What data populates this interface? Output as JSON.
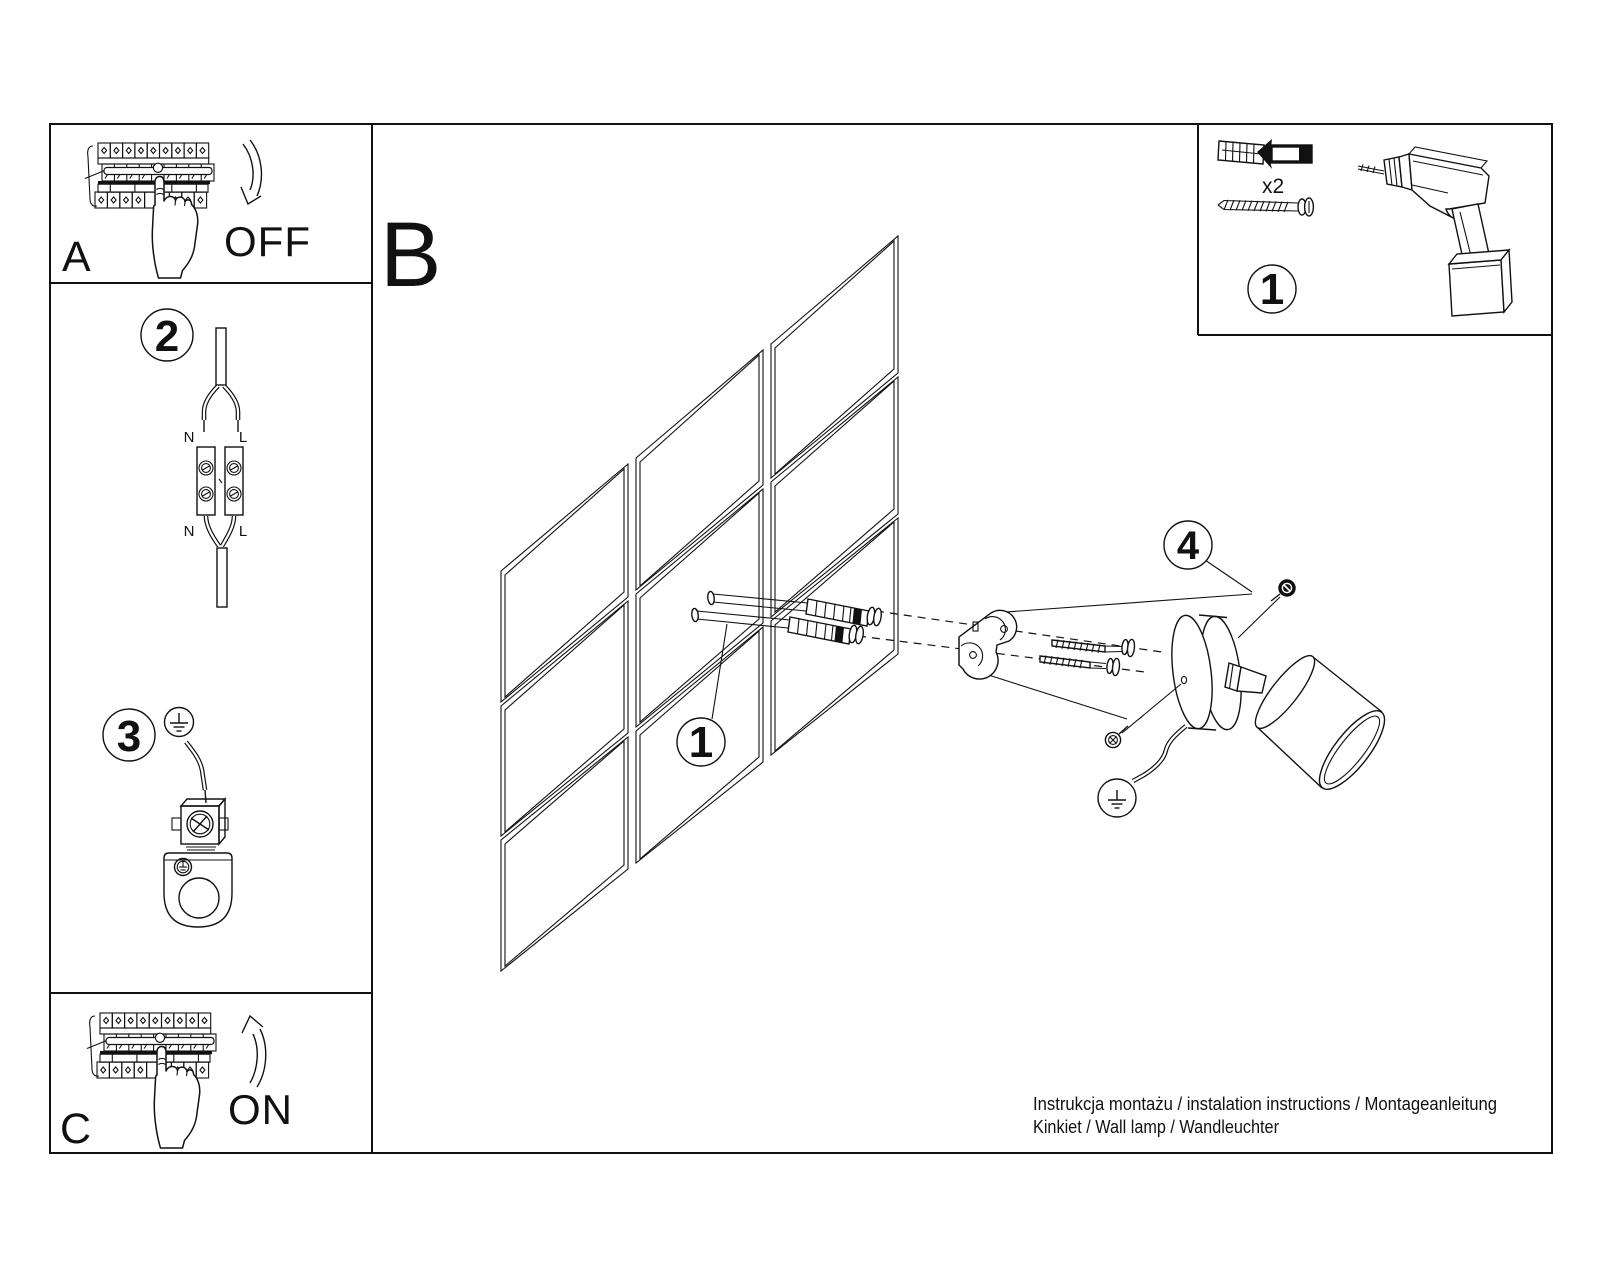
{
  "colors": {
    "ink": "#111111",
    "paper": "#ffffff"
  },
  "sections": {
    "a": "A",
    "b": "B",
    "c": "C"
  },
  "breaker": {
    "off": "OFF",
    "on": "ON"
  },
  "steps": {
    "wall": "1",
    "parts": "1",
    "wiring": "2",
    "ground": "3",
    "lamp": "4"
  },
  "wiring": {
    "n_top": "N",
    "l_top": "L",
    "n_bot": "N",
    "l_bot": "L"
  },
  "parts": {
    "qty": "x2"
  },
  "footer": {
    "line1": "Instrukcja montażu / instalation instructions / Montageanleitung",
    "line2": "Kinkiet / Wall lamp / Wandleuchter"
  }
}
